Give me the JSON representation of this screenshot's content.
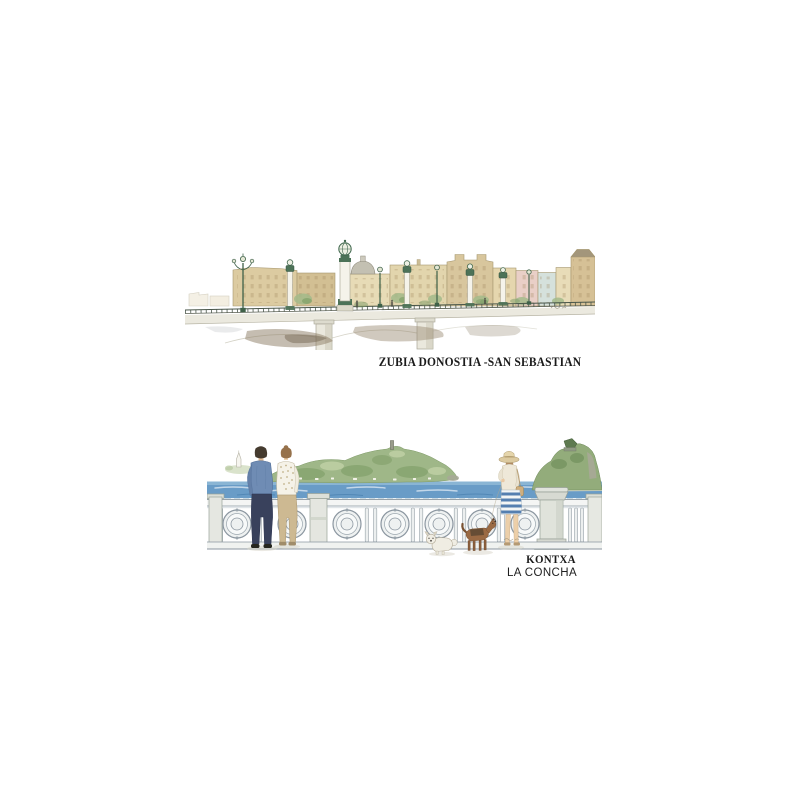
{
  "page": {
    "background_color": "#ffffff",
    "text_color": "#1b1b1b"
  },
  "top_artwork": {
    "caption": "ZUBIA DONOSTIA -SAN SEBASTIAN"
  },
  "bottom_artwork": {
    "caption_primary": "KONTXA",
    "caption_secondary": "LA CONCHA"
  },
  "icons": {
    "artist_signature": "handwritten-squiggle"
  },
  "palette": {
    "building_tan": "#dccba1",
    "building_pink": "#e9cfc7",
    "building_blue": "#d5e1dc",
    "bridge_green": "#4c7257",
    "water_reflection_brown": "#8c7b64",
    "sea_blue": "#6197c4",
    "hill_green": "#9cb585",
    "balustrade_gray": "#8b96a0",
    "shirt_blue": "#6f8cb4",
    "pants_navy": "#39415c",
    "skirt_stripe_blue": "#4c79ac",
    "terrier_brown": "#9a6a44"
  }
}
